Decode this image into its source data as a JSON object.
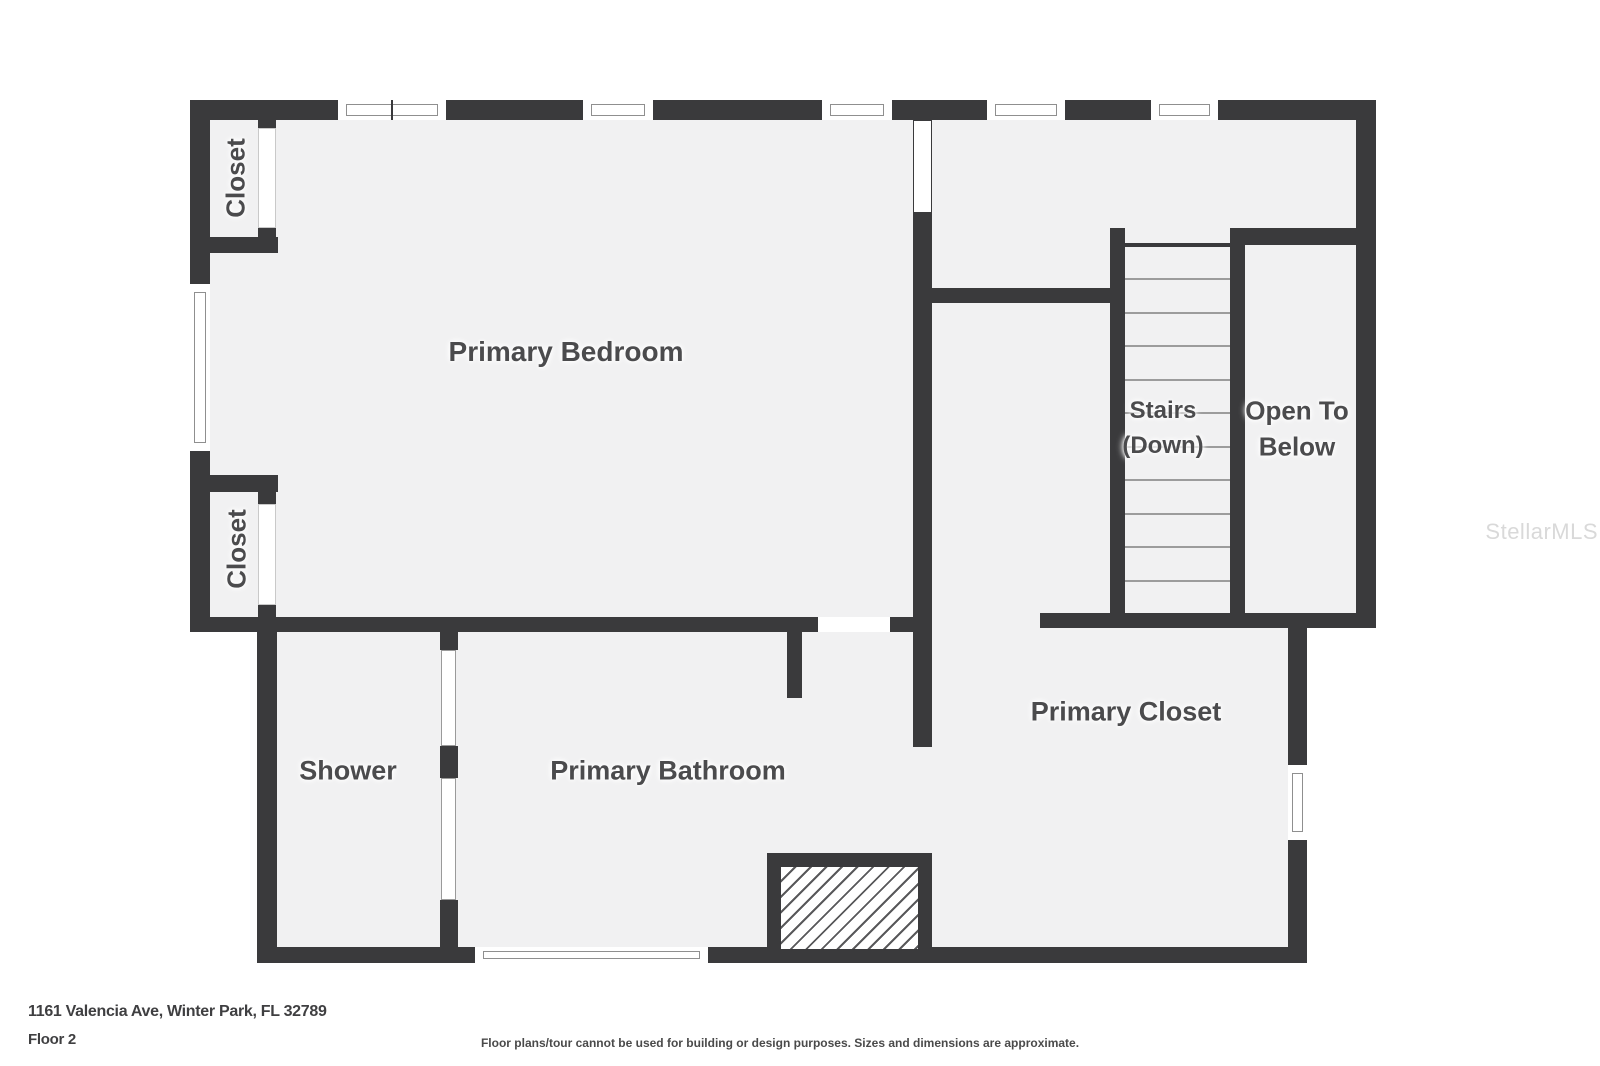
{
  "watermark": "StellarMLS",
  "footer": {
    "address": "1161 Valencia Ave, Winter Park, FL 32789",
    "floor": "Floor 2",
    "disclaimer": "Floor plans/tour cannot be used for building or design purposes. Sizes and dimensions are approximate."
  },
  "labels": {
    "primary_bedroom": "Primary Bedroom",
    "shower": "Shower",
    "primary_bathroom": "Primary Bathroom",
    "primary_closet": "Primary Closet",
    "stairs_line1": "Stairs",
    "stairs_line2": "(Down)",
    "open_below_line1": "Open To",
    "open_below_line2": "Below",
    "closet_top_left": "Closet",
    "closet_bottom_left": "Closet"
  },
  "colors": {
    "page": "#ffffff",
    "wall": "#3a3a3c",
    "floor": "#f1f1f2",
    "label": "#4b4b4d",
    "tread": "#9c9c9c",
    "frame": "#8f8f8f",
    "footer": "#3f3f41",
    "watermark": "#d9d9d9",
    "hatch": "#59595b"
  },
  "plan": {
    "floors": [
      {
        "name": "floor-upper-section",
        "x": 190,
        "y": 100,
        "w": 1186,
        "h": 528
      },
      {
        "name": "floor-lower-section",
        "x": 257,
        "y": 617,
        "w": 1050,
        "h": 346
      }
    ],
    "walls": [
      {
        "name": "wall-top-outer",
        "x": 190,
        "y": 100,
        "w": 1186,
        "h": 20
      },
      {
        "name": "wall-left-outer-upper",
        "x": 190,
        "y": 100,
        "w": 20,
        "h": 532
      },
      {
        "name": "wall-right-outer-upper",
        "x": 1356,
        "y": 100,
        "w": 20,
        "h": 528
      },
      {
        "name": "wall-closet1-bottom",
        "x": 190,
        "y": 237,
        "w": 88,
        "h": 16
      },
      {
        "name": "wall-closet1-jamb-top",
        "x": 258,
        "y": 120,
        "w": 18,
        "h": 8
      },
      {
        "name": "wall-closet1-jamb-bottom",
        "x": 258,
        "y": 228,
        "w": 18,
        "h": 9
      },
      {
        "name": "wall-closet2-top",
        "x": 190,
        "y": 475,
        "w": 88,
        "h": 17
      },
      {
        "name": "wall-closet2-jamb-top",
        "x": 258,
        "y": 492,
        "w": 18,
        "h": 12
      },
      {
        "name": "wall-closet2-jamb-bottom",
        "x": 258,
        "y": 605,
        "w": 18,
        "h": 12
      },
      {
        "name": "wall-bedroom-south-left",
        "x": 190,
        "y": 617,
        "w": 628,
        "h": 15
      },
      {
        "name": "wall-bedroom-south-right",
        "x": 890,
        "y": 617,
        "w": 42,
        "h": 15
      },
      {
        "name": "wall-bathroom-entry-stub",
        "x": 787,
        "y": 632,
        "w": 15,
        "h": 66
      },
      {
        "name": "wall-center-vertical",
        "x": 913,
        "y": 120,
        "w": 19,
        "h": 627
      },
      {
        "name": "wall-hall-south",
        "x": 932,
        "y": 288,
        "w": 193,
        "h": 15
      },
      {
        "name": "wall-stairwell-left",
        "x": 1110,
        "y": 228,
        "w": 15,
        "h": 400
      },
      {
        "name": "wall-stairs-top-edge",
        "x": 1125,
        "y": 243,
        "w": 105,
        "h": 4
      },
      {
        "name": "wall-open-below-left",
        "x": 1230,
        "y": 228,
        "w": 15,
        "h": 400
      },
      {
        "name": "wall-open-below-top",
        "x": 1245,
        "y": 228,
        "w": 111,
        "h": 17
      },
      {
        "name": "wall-upper-south",
        "x": 1040,
        "y": 613,
        "w": 336,
        "h": 15
      },
      {
        "name": "wall-primary-closet-right",
        "x": 1288,
        "y": 628,
        "w": 19,
        "h": 335
      },
      {
        "name": "wall-lower-left",
        "x": 257,
        "y": 632,
        "w": 20,
        "h": 331
      },
      {
        "name": "wall-lower-south",
        "x": 257,
        "y": 947,
        "w": 1050,
        "h": 16
      },
      {
        "name": "wall-shower-partition-top",
        "x": 440,
        "y": 632,
        "w": 18,
        "h": 18
      },
      {
        "name": "wall-shower-partition-mid",
        "x": 440,
        "y": 746,
        "w": 18,
        "h": 32
      },
      {
        "name": "wall-shower-partition-bottom",
        "x": 440,
        "y": 900,
        "w": 18,
        "h": 47
      }
    ],
    "glass": [
      {
        "name": "shower-glass-upper",
        "x": 441,
        "y": 650,
        "w": 15,
        "h": 96
      },
      {
        "name": "shower-glass-lower",
        "x": 441,
        "y": 778,
        "w": 15,
        "h": 122
      }
    ],
    "doors": [
      {
        "name": "door-closet-top-left",
        "x": 258,
        "y": 128,
        "w": 18,
        "h": 100,
        "frame": true
      },
      {
        "name": "door-closet-bottom-left",
        "x": 258,
        "y": 504,
        "w": 18,
        "h": 101,
        "frame": true
      },
      {
        "name": "door-center-wall",
        "x": 914,
        "y": 121,
        "w": 17,
        "h": 91,
        "frame": false
      },
      {
        "name": "door-bedroom-south",
        "x": 818,
        "y": 617,
        "w": 72,
        "h": 15,
        "frame": false
      }
    ],
    "windows": [
      {
        "name": "window-top-1",
        "x": 336,
        "y": 100,
        "w": 112,
        "h": 20,
        "dir": "h",
        "mid": true
      },
      {
        "name": "window-top-2",
        "x": 581,
        "y": 100,
        "w": 74,
        "h": 20,
        "dir": "h",
        "mid": false
      },
      {
        "name": "window-top-3",
        "x": 820,
        "y": 100,
        "w": 74,
        "h": 20,
        "dir": "h",
        "mid": false
      },
      {
        "name": "window-top-4",
        "x": 985,
        "y": 100,
        "w": 82,
        "h": 20,
        "dir": "h",
        "mid": false
      },
      {
        "name": "window-top-5",
        "x": 1149,
        "y": 100,
        "w": 71,
        "h": 20,
        "dir": "h",
        "mid": false
      },
      {
        "name": "window-left-bedroom",
        "x": 190,
        "y": 282,
        "w": 20,
        "h": 171,
        "dir": "v",
        "mid": false
      },
      {
        "name": "window-bathroom-south",
        "x": 473,
        "y": 947,
        "w": 237,
        "h": 16,
        "dir": "h",
        "mid": false
      },
      {
        "name": "window-primary-closet-right",
        "x": 1288,
        "y": 763,
        "w": 19,
        "h": 79,
        "dir": "v",
        "mid": false
      }
    ],
    "stair_treads": {
      "x": 1125,
      "w": 105,
      "y_start": 278,
      "step": 33.5,
      "count": 10
    },
    "hatch_box": {
      "name": "hatched-chase",
      "x": 767,
      "y": 853,
      "w": 165,
      "h": 110
    }
  }
}
